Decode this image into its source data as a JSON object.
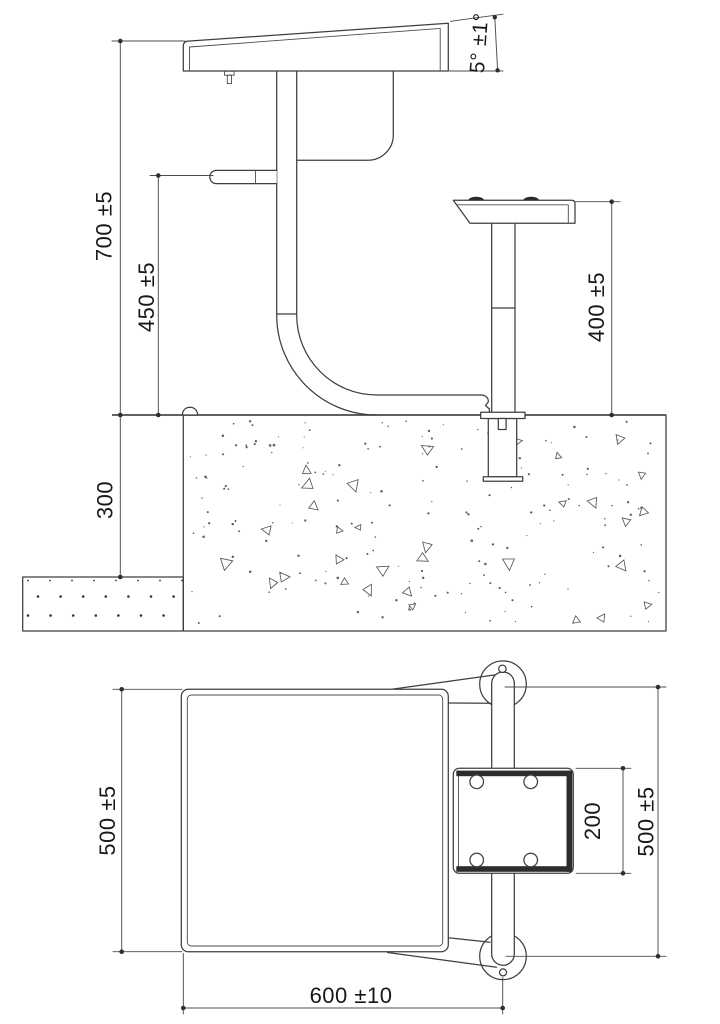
{
  "dimensions": {
    "side_view": {
      "overall_height": "700 ±5",
      "hook_height": "450 ±5",
      "seat_height": "400 ±5",
      "embed_depth": "300",
      "top_angle": "5° ±1°"
    },
    "plan_view": {
      "desk_depth_left": "500 ±5",
      "desk_width": "600 ±10",
      "seat_depth": "200",
      "overall_depth_right": "500 ±5"
    }
  },
  "colors": {
    "line": "#3f3f3f",
    "text": "#181818",
    "background": "#ffffff"
  }
}
